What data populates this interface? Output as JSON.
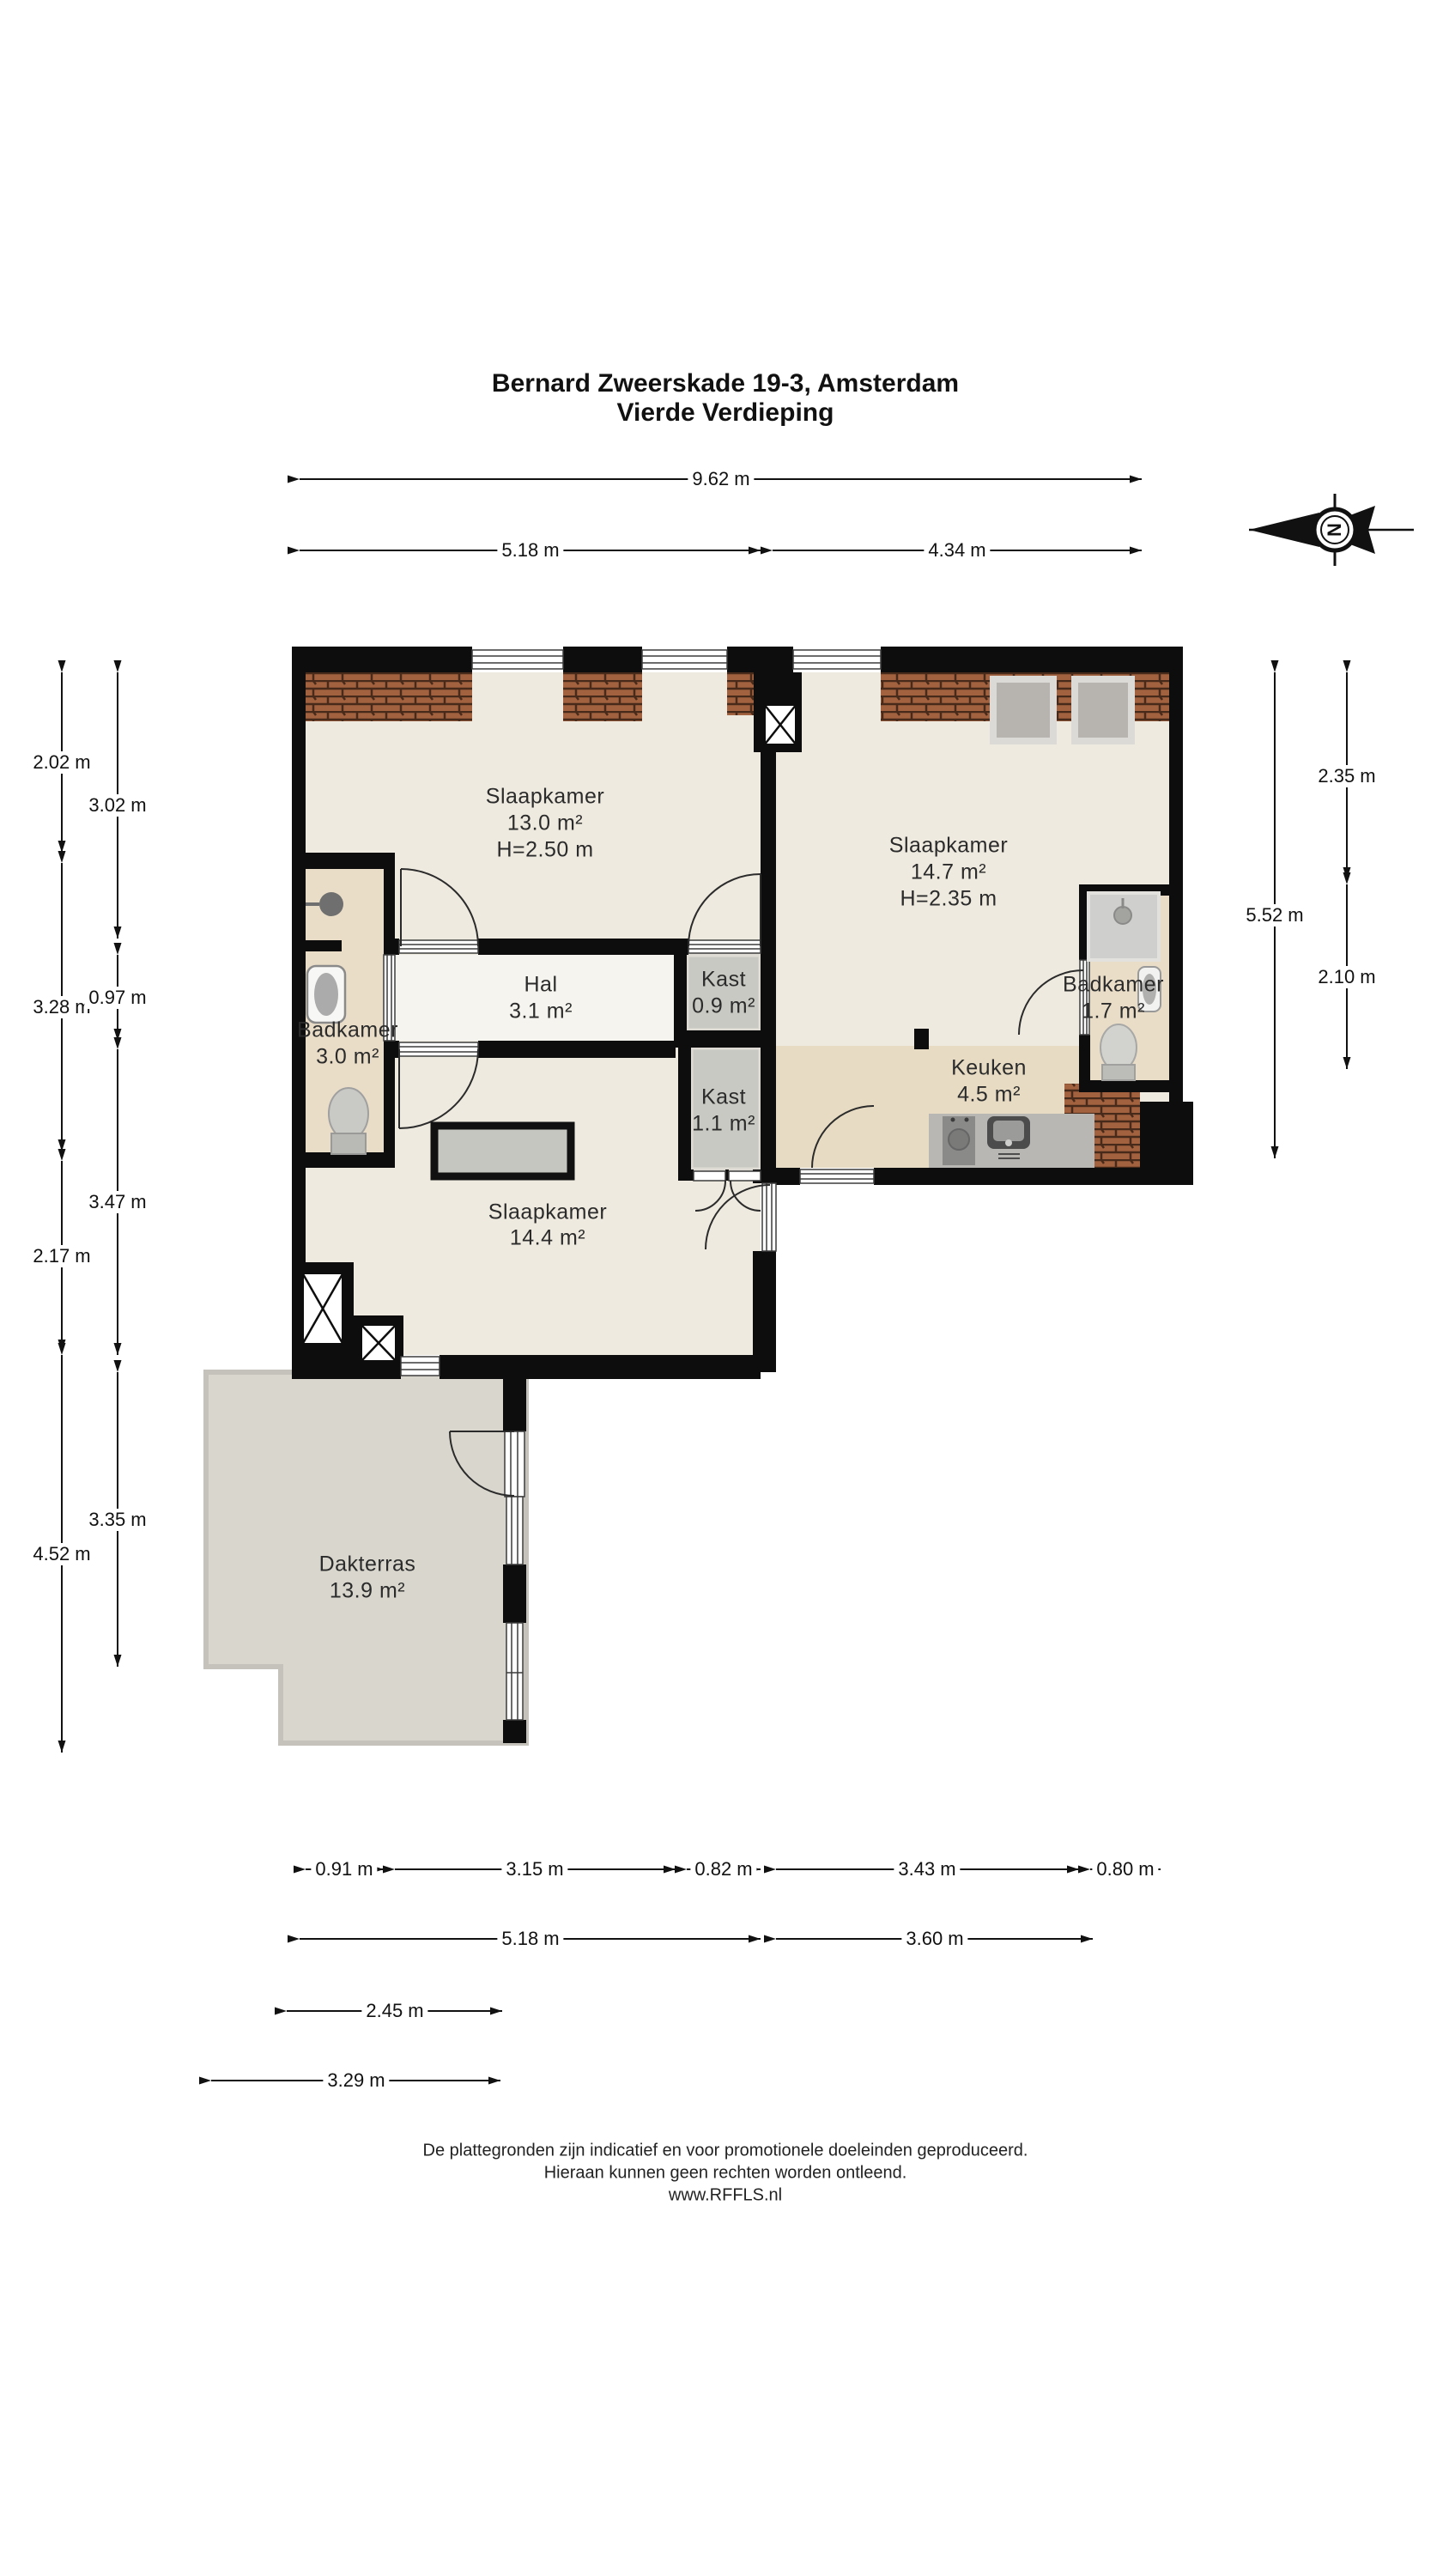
{
  "title": {
    "line1": "Bernard Zweerskade 19-3, Amsterdam",
    "line2": "Vierde Verdieping"
  },
  "compass": {
    "north_label": "N"
  },
  "rooms": {
    "slaapkamer_13": {
      "name": "Slaapkamer",
      "area": "13.0 m²",
      "ceiling": "H=2.50 m"
    },
    "slaapkamer_147": {
      "name": "Slaapkamer",
      "area": "14.7 m²",
      "ceiling": "H=2.35 m"
    },
    "slaapkamer_144": {
      "name": "Slaapkamer",
      "area": "14.4 m²"
    },
    "hal": {
      "name": "Hal",
      "area": "3.1 m²"
    },
    "kast_09": {
      "name": "Kast",
      "area": "0.9 m²"
    },
    "kast_11": {
      "name": "Kast",
      "area": "1.1 m²"
    },
    "badkamer_30": {
      "name": "Badkamer",
      "area": "3.0 m²"
    },
    "badkamer_17": {
      "name": "Badkamer",
      "area": "1.7 m²"
    },
    "keuken": {
      "name": "Keuken",
      "area": "4.5 m²"
    },
    "dakterras": {
      "name": "Dakterras",
      "area": "13.9 m²"
    }
  },
  "dimensions": {
    "top_total": "9.62 m",
    "top_left": "5.18 m",
    "top_right": "4.34 m",
    "left_outer": [
      "2.02 m",
      "3.28 m",
      "2.17 m",
      "4.52 m"
    ],
    "left_inner": [
      "3.02 m",
      "0.97 m",
      "3.47 m",
      "3.35 m"
    ],
    "right_total": "5.52 m",
    "right_inner": [
      "2.35 m",
      "2.10 m"
    ],
    "bottom_row1": [
      "0.91 m",
      "3.15 m",
      "0.82 m",
      "3.43 m",
      "0.80 m"
    ],
    "bottom_row2": [
      "5.18 m",
      "3.60 m"
    ],
    "bottom_row3": "2.45 m",
    "bottom_row4": "3.29 m"
  },
  "footer": {
    "line1": "De plattegronden zijn indicatief en voor promotionele doeleinden geproduceerd.",
    "line2": "Hieraan kunnen geen rechten worden ontleend.",
    "line3": "www.RFFLS.nl"
  },
  "colors": {
    "wall": "#0d0d0d",
    "floor": "#eeeadf",
    "hal_floor": "#f6f4ee",
    "wet_floor": "#e9ddc8",
    "kitchen_floor": "#e7dcc3",
    "closet_floor": "#c9c9c3",
    "terrace_floor": "#d8d6cd",
    "brick": "#a2613f"
  }
}
